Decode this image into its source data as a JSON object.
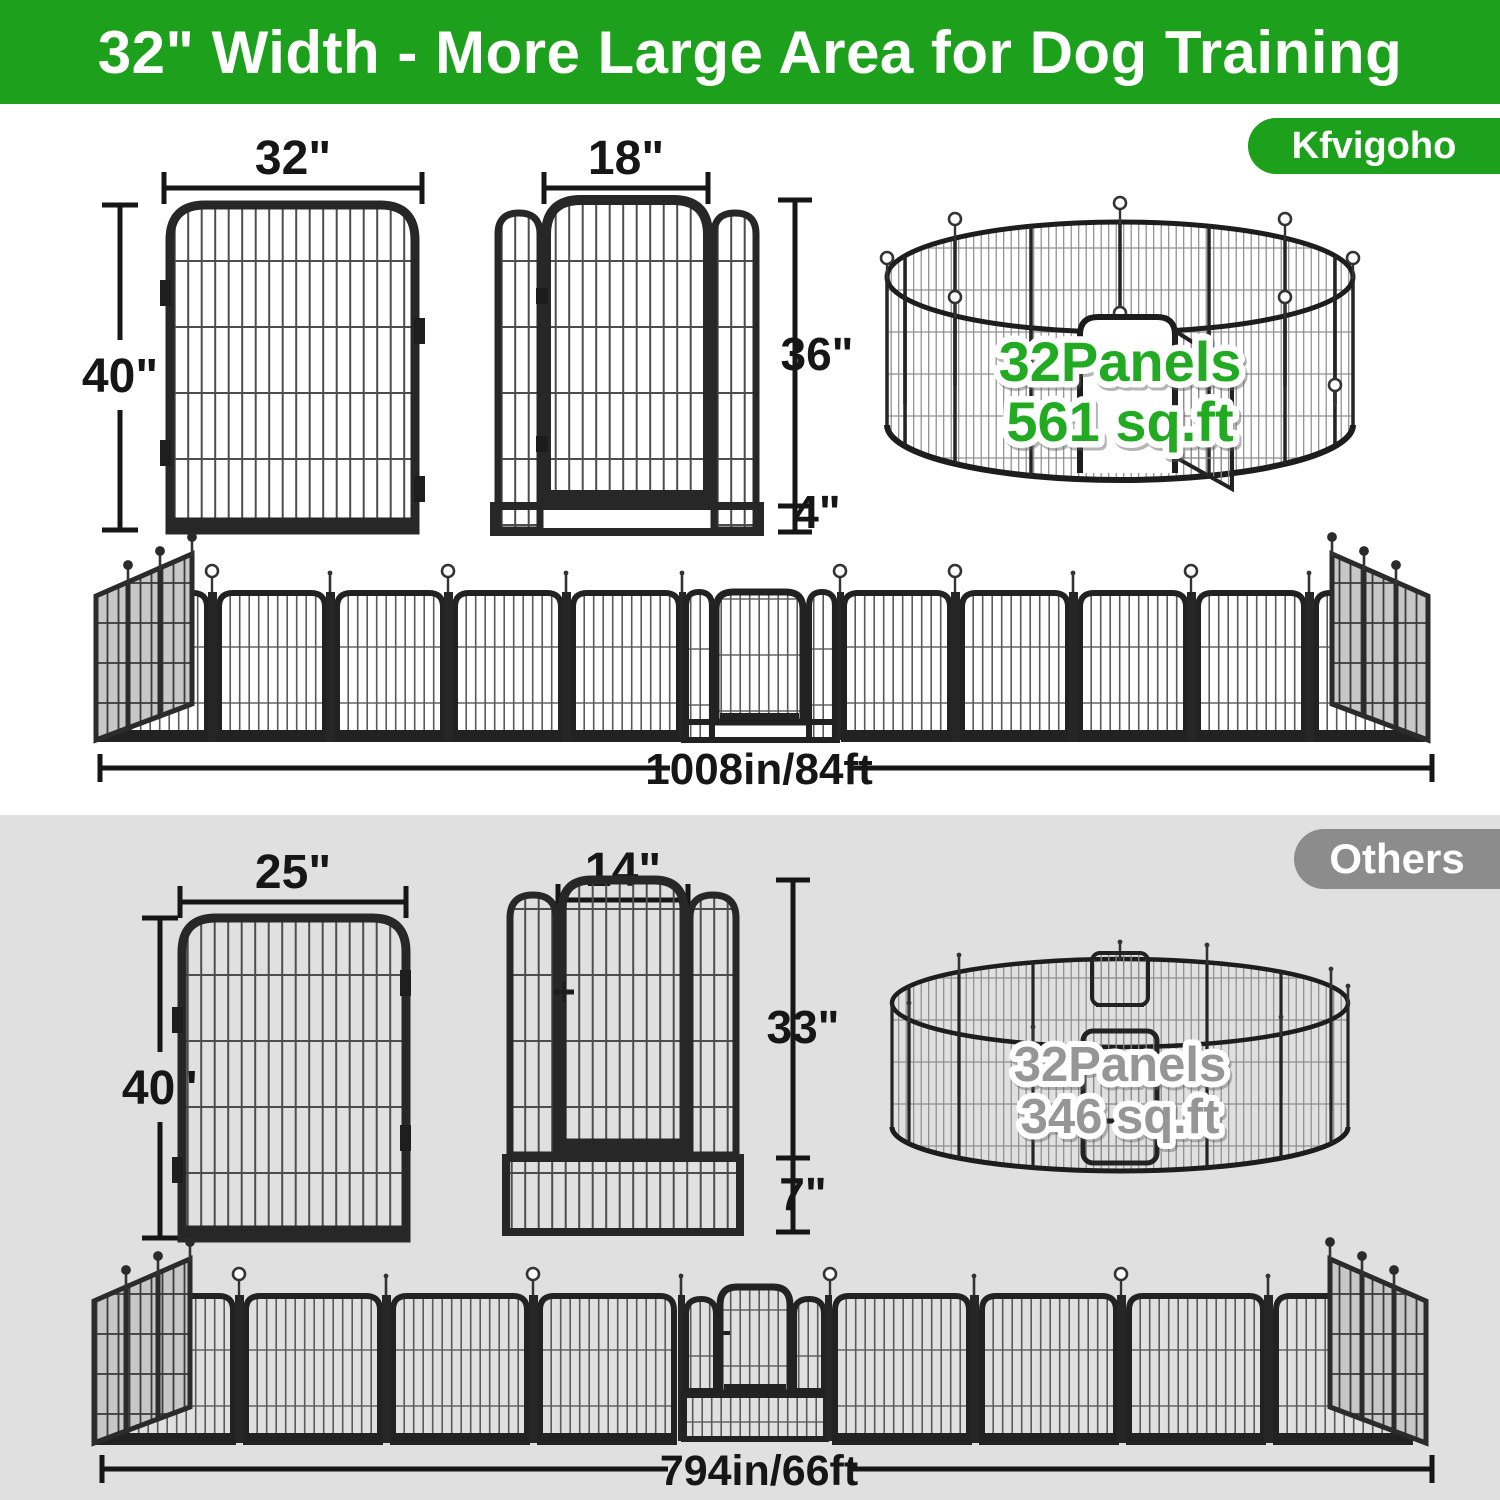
{
  "banner": {
    "title": "32\" Width - More Large Area for Dog Training"
  },
  "brand_badge": "Kfvigoho",
  "others_badge": "Others",
  "kfvigoho": {
    "panel": {
      "width": "32\"",
      "height": "40\""
    },
    "door_panel": {
      "door_width": "18\"",
      "door_height": "36\"",
      "ground_gap": "4\""
    },
    "pen": {
      "panels": "32Panels",
      "area": "561 sq.ft"
    },
    "row": {
      "total_length": "1008in/84ft"
    }
  },
  "others": {
    "panel": {
      "width": "25\"",
      "height": "40\""
    },
    "door_panel": {
      "door_width": "14\"",
      "door_height": "33\"",
      "bottom_height": "7\""
    },
    "pen": {
      "panels": "32Panels",
      "area": "346 sq.ft"
    },
    "row": {
      "total_length": "794in/66ft"
    }
  },
  "colors": {
    "brand_green": "#1da11d",
    "pen_text_green": "#22ab22",
    "others_gray": "#8c8c8c",
    "pen_text_gray": "#969696",
    "section_gray": "#e0e0e0",
    "ink": "#161616"
  }
}
